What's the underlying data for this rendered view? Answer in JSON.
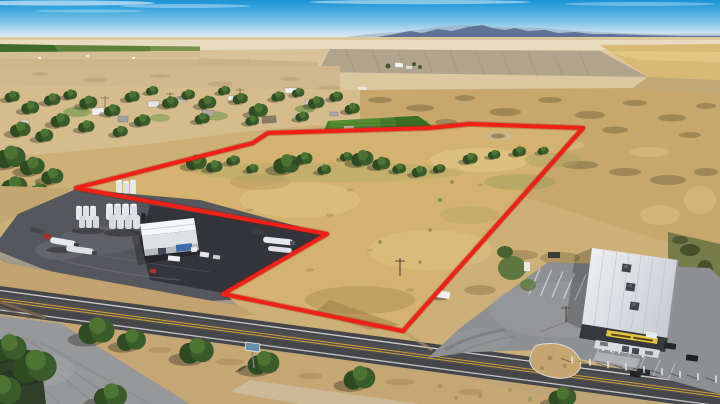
{
  "meta": {
    "title": "Aerial drone photo of rural land parcel outlined in red",
    "type": "photograph",
    "description": "Aerial view of a dry-grass parcel outlined with a red boundary line, bordered by an industrial tank facility, a two-lane highway, rural homes, farm fields, distant mountains, and a retail building with a yellow sign and parking lot."
  },
  "boundary": {
    "label": "property-boundary-outline",
    "color": "#ef2015",
    "halo_color": "#8e100a",
    "svg_points": "76,188 253,143 268,133 430,128 470,124 583,128 403,331 223,294 327,234"
  },
  "palette": {
    "sky_top": "#1d93d4",
    "sky_horizon": "#eaf1f1",
    "mountains": "#5f7396",
    "far_fields": "#dcc89e",
    "green_crop_field": "#4a7a2b",
    "dry_grass_parcel": "#d4b270",
    "industrial_asphalt": "#56575c",
    "highway_asphalt": "#45464a",
    "highway_centerline_yellow": "#cf9f33",
    "parking_lot": "#8d8f92",
    "store_roof": "#eef0f2",
    "store_sign_yellow": "#e7c43c",
    "tank_white": "#e4e7ea"
  },
  "scene": {
    "regions": [
      {
        "name": "sky",
        "label": "Blue sky with thin white clouds"
      },
      {
        "name": "mountain-range",
        "label": "Hazy blue mountain range on horizon"
      },
      {
        "name": "far-farmland",
        "label": "Distant plowed and harvested wheat fields"
      },
      {
        "name": "village",
        "label": "Rural homes with trees along a small town strip"
      },
      {
        "name": "green-field",
        "label": "Irrigated bright green crop field"
      },
      {
        "name": "outlined-parcel",
        "label": "Vacant dry-grass land parcel outlined in red"
      },
      {
        "name": "tank-facility",
        "label": "Industrial yard with white storage tanks, warehouse and tanker trucks"
      },
      {
        "name": "highway",
        "label": "Two-lane highway with double yellow centerline"
      },
      {
        "name": "roadside-sign",
        "label": "Small blue roadside sign on post"
      },
      {
        "name": "retail-store",
        "label": "Retail building with white metal roof, yellow storefront sign and striped parking lot"
      }
    ]
  }
}
